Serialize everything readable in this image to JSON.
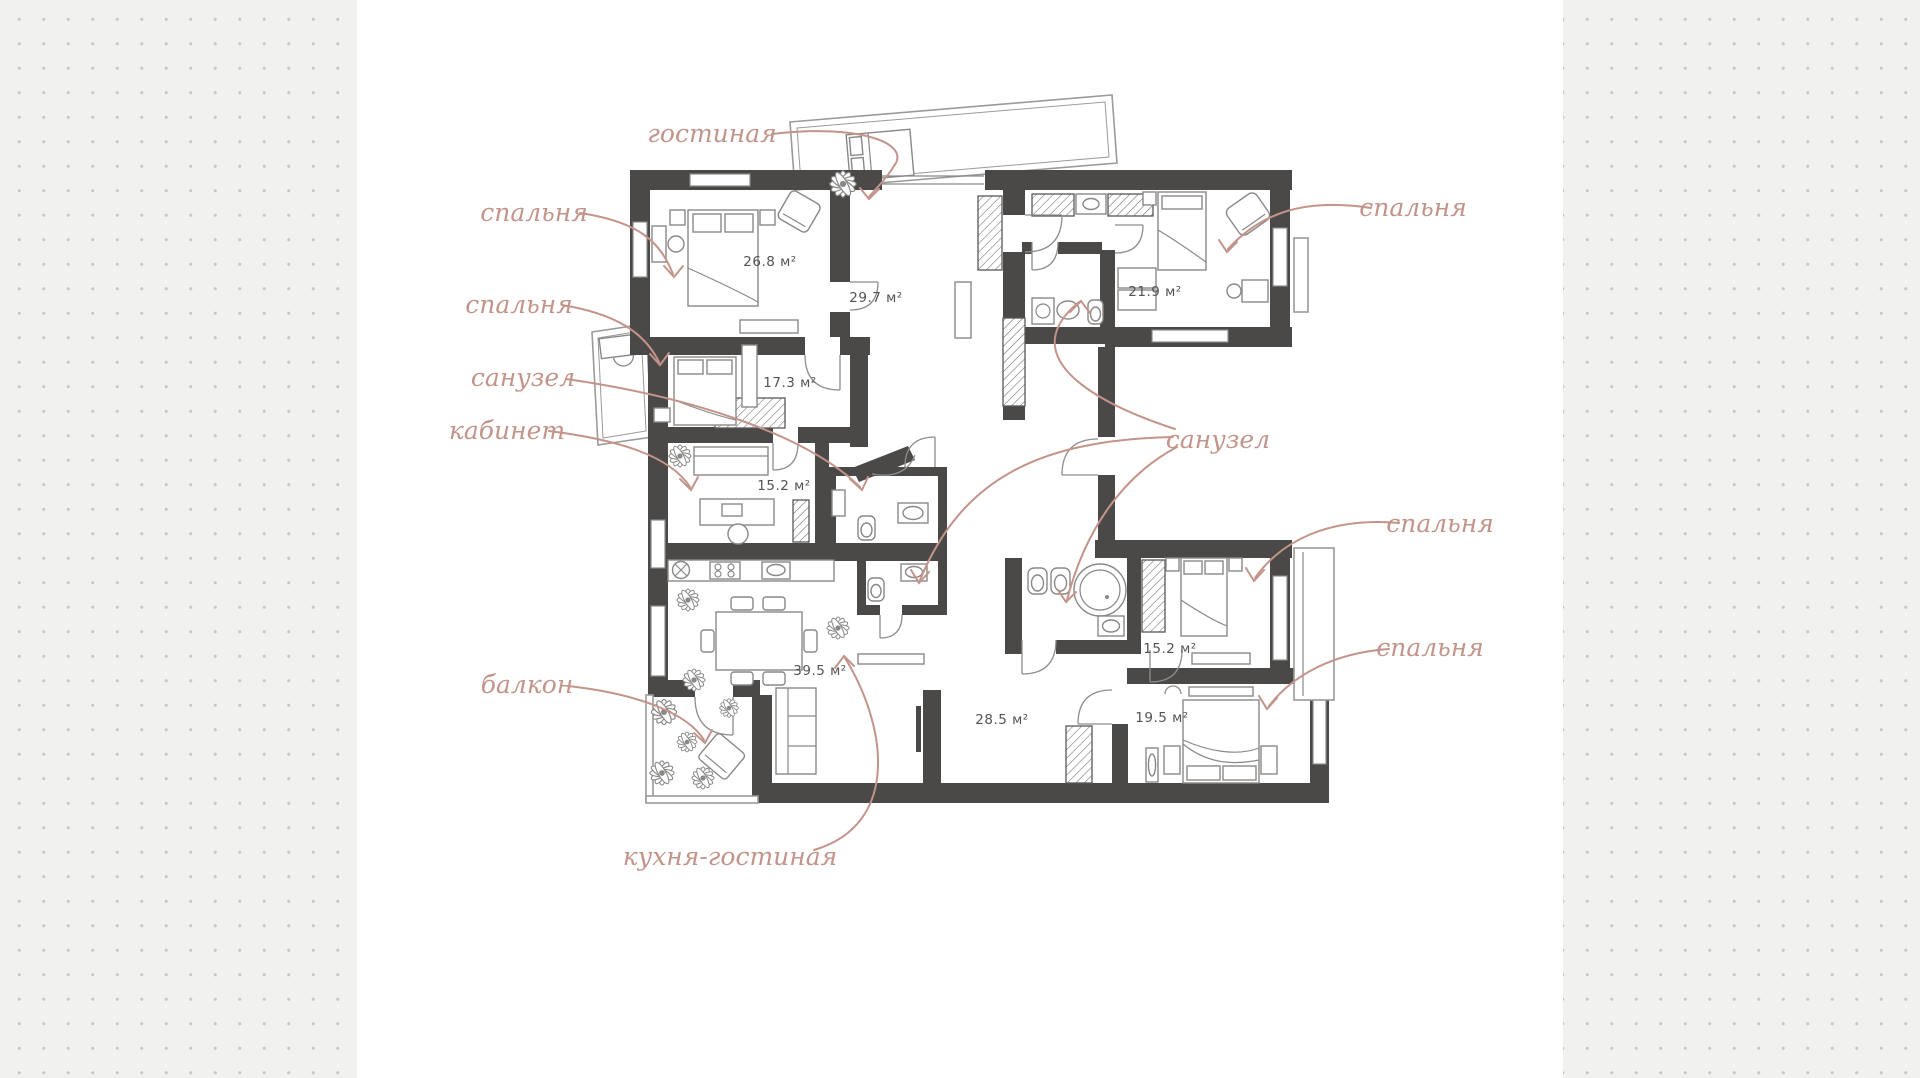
{
  "canvas": {
    "width": 1920,
    "height": 1078,
    "background": "#f1f1f0",
    "dot_color": "#c7c7c6",
    "panel_color": "#ffffff"
  },
  "palette": {
    "wall": "#4b4947",
    "label": "#c2948a",
    "area_text": "#56534f",
    "furniture_line": "#8a8886"
  },
  "callouts": [
    {
      "id": "living",
      "text": "гостиная"
    },
    {
      "id": "bedroom-top-left",
      "text": "спальня"
    },
    {
      "id": "bedroom-left",
      "text": "спальня"
    },
    {
      "id": "bathroom-left",
      "text": "санузел"
    },
    {
      "id": "office",
      "text": "кабинет"
    },
    {
      "id": "balcony",
      "text": "балкон"
    },
    {
      "id": "kitchen-living",
      "text": "кухня-гостиная"
    },
    {
      "id": "bedroom-top-right",
      "text": "спальня"
    },
    {
      "id": "bathrooms-right",
      "text": "санузел"
    },
    {
      "id": "bedroom-mid-right",
      "text": "спальня"
    },
    {
      "id": "bedroom-bottom-right",
      "text": "спальня"
    }
  ],
  "area_labels": [
    {
      "room": "bedroom-top-left",
      "text": "26.8 м²"
    },
    {
      "room": "living",
      "text": "29.7 м²"
    },
    {
      "room": "bedroom-top-right",
      "text": "21.9 м²"
    },
    {
      "room": "bedroom-left",
      "text": "17.3 м²"
    },
    {
      "room": "office",
      "text": "15.2 м²"
    },
    {
      "room": "kitchen-living",
      "text": "39.5 м²"
    },
    {
      "room": "hall",
      "text": "28.5 м²"
    },
    {
      "room": "bedroom-mid-right",
      "text": "15.2 м²"
    },
    {
      "room": "bedroom-bottom-right",
      "text": "19.5 м²"
    }
  ],
  "rooms": [
    {
      "name": "гостиная",
      "area_m2": 29.7
    },
    {
      "name": "спальня",
      "area_m2": 26.8
    },
    {
      "name": "спальня",
      "area_m2": 17.3
    },
    {
      "name": "спальня",
      "area_m2": 21.9
    },
    {
      "name": "кабинет",
      "area_m2": 15.2
    },
    {
      "name": "кухня-гостиная",
      "area_m2": 39.5
    },
    {
      "name": "спальня",
      "area_m2": 15.2
    },
    {
      "name": "спальня",
      "area_m2": 19.5
    },
    {
      "name": "холл",
      "area_m2": 28.5
    }
  ]
}
